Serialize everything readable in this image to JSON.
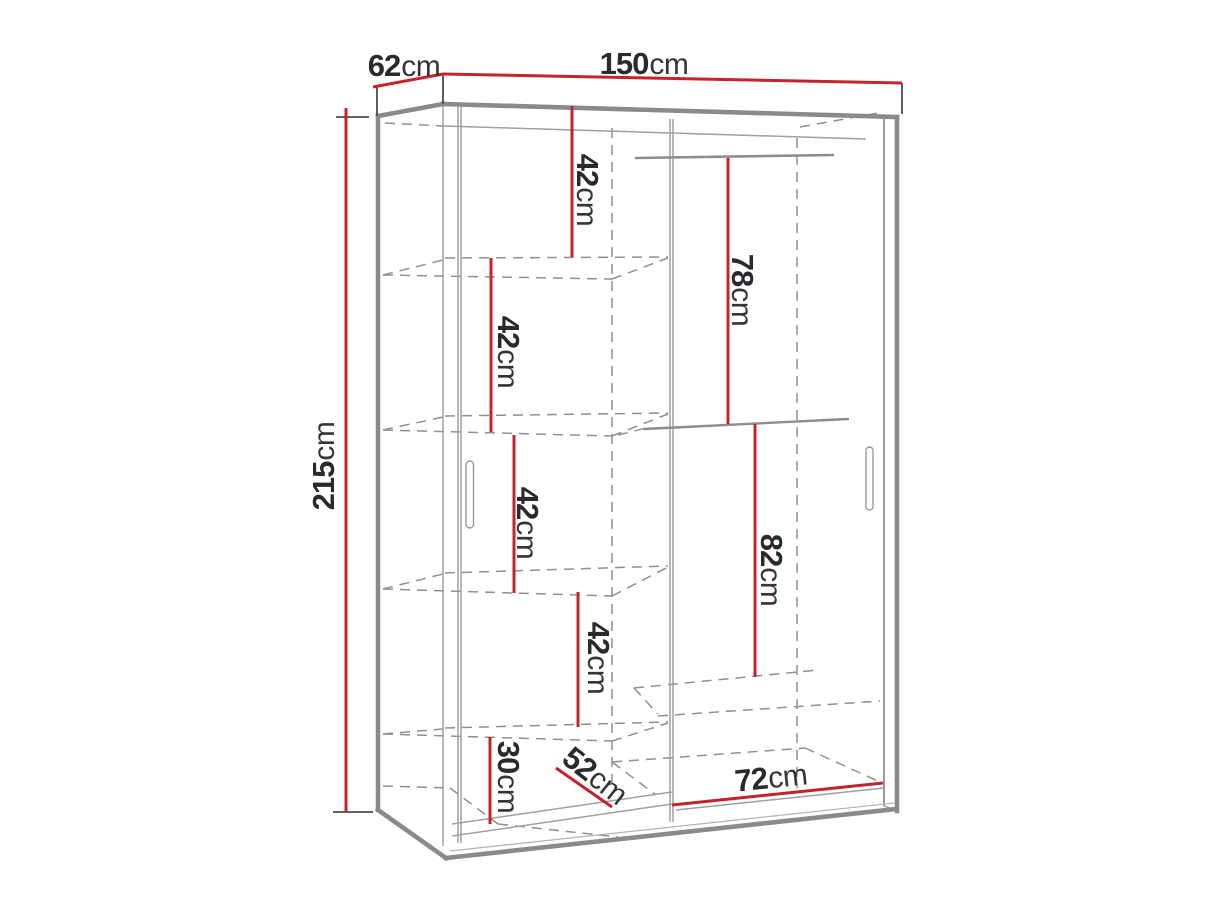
{
  "diagram": {
    "title": "Sliding-door wardrobe dimension diagram",
    "unit": "cm"
  },
  "colors": {
    "accent": "#C4232E",
    "outline": "#8A8A8A",
    "text": "#2A292D"
  },
  "overall": {
    "width": {
      "value": "150",
      "unit": "cm"
    },
    "depth": {
      "value": "62",
      "unit": "cm"
    },
    "height": {
      "value": "215",
      "unit": "cm"
    }
  },
  "interior": {
    "shelf_1": {
      "value": "42",
      "unit": "cm"
    },
    "shelf_2": {
      "value": "42",
      "unit": "cm"
    },
    "shelf_3": {
      "value": "42",
      "unit": "cm"
    },
    "shelf_4": {
      "value": "42",
      "unit": "cm"
    },
    "bottom_left": {
      "value": "30",
      "unit": "cm"
    },
    "hanging_top": {
      "value": "78",
      "unit": "cm"
    },
    "hanging_bottom": {
      "value": "82",
      "unit": "cm"
    },
    "left_compartment_width": {
      "value": "52",
      "unit": "cm"
    },
    "right_compartment_width": {
      "value": "72",
      "unit": "cm"
    }
  }
}
